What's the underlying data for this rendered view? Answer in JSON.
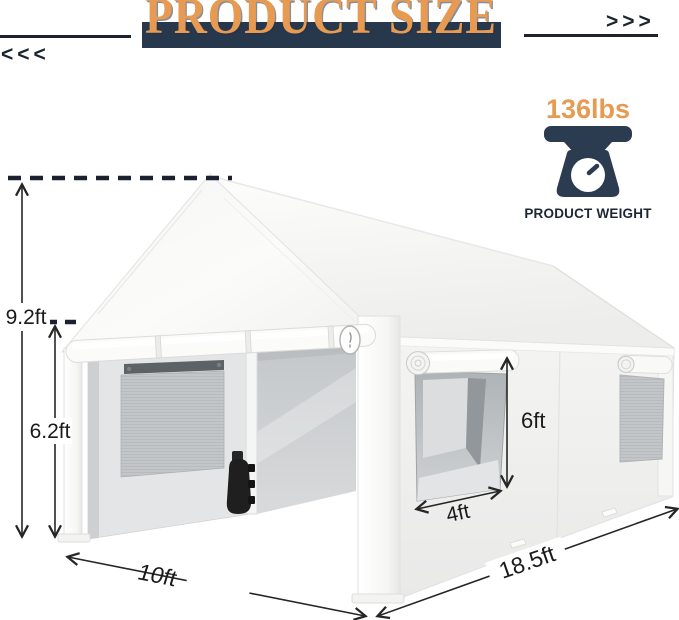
{
  "theme": {
    "accent": "#E69A52",
    "navy": "#27374C",
    "ink": "#1C2330",
    "label": "#1A1A1A"
  },
  "header": {
    "title": "PRODUCT SIZE",
    "left_chevrons": "<<<",
    "right_chevrons": ">>>"
  },
  "weight": {
    "value": "136lbs",
    "label": "PRODUCT WEIGHT",
    "icon": "scale-icon"
  },
  "diagram": {
    "product": "white carport canopy garage tent",
    "dimensions": {
      "peak_height": "9.2ft",
      "eave_height": "6.2ft",
      "door_height": "6ft",
      "door_width": "4ft",
      "front_width": "10ft",
      "side_length": "18.5ft"
    }
  }
}
